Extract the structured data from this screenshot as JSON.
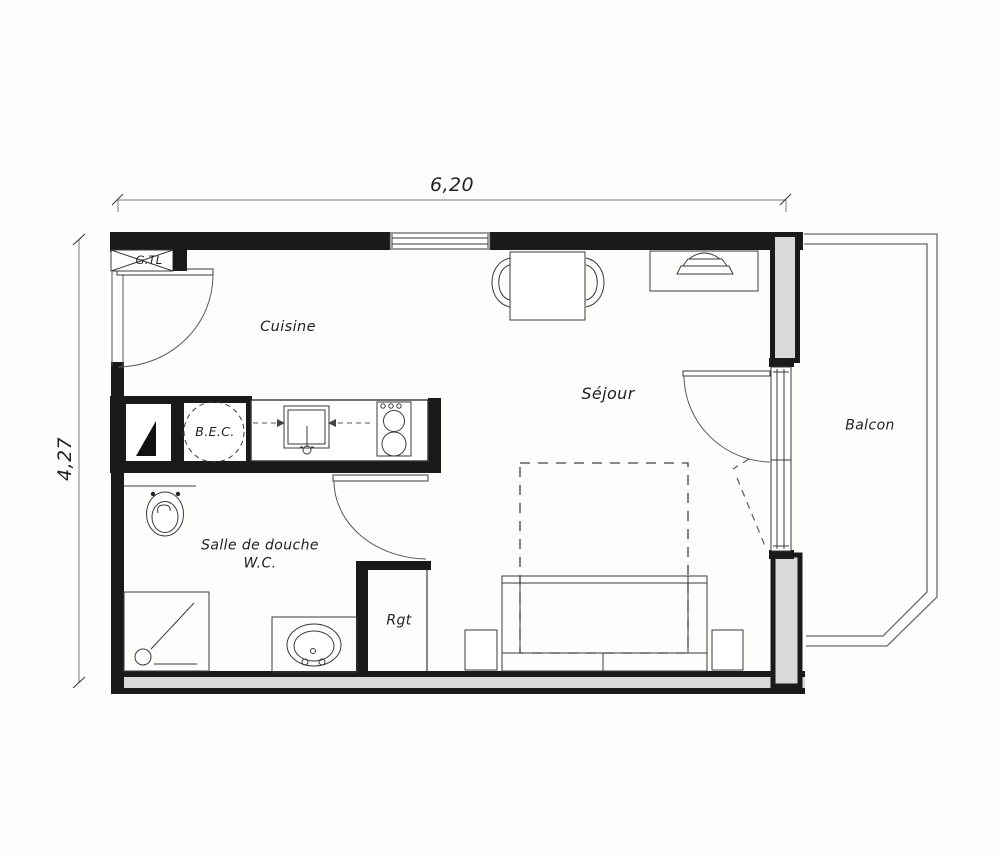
{
  "plan": {
    "title": "Studio apartment floor plan (scanned architectural drawing)",
    "dimensions": {
      "width": {
        "label": "6,20"
      },
      "height": {
        "label": "4,27"
      }
    },
    "rooms": {
      "cuisine": {
        "label": "Cuisine"
      },
      "sejour": {
        "label": "Séjour"
      },
      "shower_room": {
        "label_line1": "Salle de douche",
        "label_line2": "W.C."
      },
      "storage": {
        "label": "Rgt"
      },
      "balcony": {
        "label": "Balcon"
      }
    },
    "labels": {
      "technical_duct": "G.TL",
      "water_heater": "B.E.C."
    },
    "colors": {
      "ink": "#2b2b2b",
      "wall_black": "#1a1a1a",
      "wall_gray": "#d9d9d9",
      "paper": "#fdfdfc",
      "dimension_line": "#7a7a7a"
    },
    "fixture_icons": [
      "entrance-door-icon",
      "window-icon",
      "french-window-icon",
      "toilet-icon",
      "shower-icon",
      "washbasin-icon",
      "kitchen-sink-icon",
      "stove-icon",
      "water-heater-icon",
      "duct-icon",
      "dining-table-icon",
      "chair-icon",
      "sofa-bed-icon",
      "bed-outline-icon",
      "side-table-icon",
      "desk-icon",
      "lamp-icon"
    ]
  }
}
